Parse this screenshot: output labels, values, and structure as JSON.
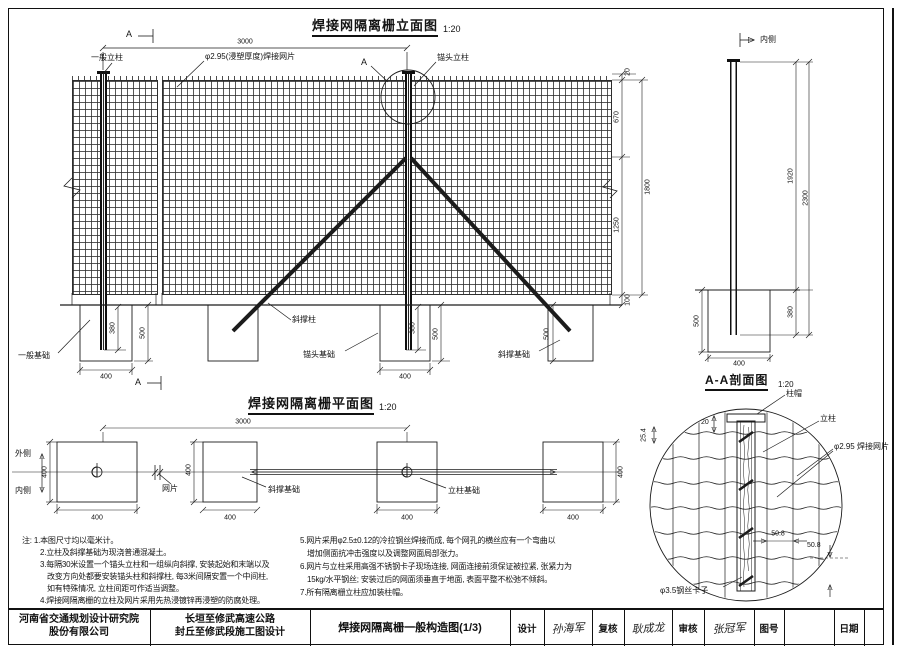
{
  "elevation": {
    "title": "焊接网隔离栅立面图",
    "scale": "1:20",
    "labels": {
      "post": "一般立柱",
      "mesh": "φ2.95(浸塑厚度)焊接网片",
      "anchor_post": "锚头立柱",
      "brace": "斜撑柱",
      "foundation_general": "一般基础",
      "foundation_anchor": "锚头基础",
      "foundation_brace": "斜撑基础",
      "marker": "A"
    },
    "dims": {
      "span": "3000",
      "top": "20",
      "upper": "670",
      "lower": "1250",
      "height": "1800",
      "gap": "100",
      "embed": "380",
      "depth": "500",
      "width": "400"
    }
  },
  "post_view": {
    "label": "内侧",
    "dims": {
      "above": "1920",
      "total": "2300",
      "embed": "380",
      "width": "400",
      "depth": "500"
    }
  },
  "plan": {
    "title": "焊接网隔离栅平面图",
    "scale": "1:20",
    "labels": {
      "outer": "外侧",
      "inner": "内侧",
      "mesh": "网片",
      "brace_foundation": "斜撑基础",
      "post_foundation": "立柱基础"
    },
    "dims": {
      "span": "3000",
      "size": "400"
    }
  },
  "section": {
    "title": "A-A剖面图",
    "scale": "1:20",
    "labels": {
      "cap": "柱帽",
      "post": "立柱",
      "mesh": "φ2.95 焊接网片",
      "clip": "φ3.5钢丝卡子"
    },
    "dims": {
      "cap_gap": "20",
      "edge": "25.4",
      "h_spacing": "50.8",
      "v_spacing": "50.8"
    }
  },
  "notes": {
    "left": [
      "注: 1.本图尺寸均以毫米计。",
      "2.立柱及斜撑基础为现浇普通混凝土。",
      "3.每隔30米设置一个锚头立柱和一组纵向斜撑, 安装起始和末端以及",
      "改变方向处都要安装锚头柱和斜撑柱, 每3米间隔安置一个中间柱,",
      "如有特殊情况, 立柱间距可作适当调整。",
      "4.焊接网隔离栅的立柱及网片采用先热浸镀锌再浸塑的防腐处理。"
    ],
    "right": [
      "5.网片采用φ2.5±0.12的冷拉钢丝焊接而成, 每个网孔的横丝应有一个弯曲以",
      "增加侧面抗冲击强度以及调整网面局部张力。",
      "6.网片与立柱采用高强不锈钢卡子现场连接, 网面连接前须保证被拉紧, 张紧力为",
      "15kg/水平钢丝; 安装过后的网面须垂直于地面, 表面平整不松弛不倾斜。",
      "7.所有隔离栅立柱应加装柱帽。"
    ]
  },
  "titleblock": {
    "company": [
      "河南省交通规划设计研究院",
      "股份有限公司"
    ],
    "project": [
      "长垣至修武高速公路",
      "封丘至修武段施工图设计"
    ],
    "drawing_title": "焊接网隔离栅一般构造图(1/3)",
    "fields": [
      {
        "label": "设计",
        "value": "孙海军"
      },
      {
        "label": "复核",
        "value": "耿成龙"
      },
      {
        "label": "审核",
        "value": "张冠军"
      },
      {
        "label": "图号",
        "value": ""
      },
      {
        "label": "日期",
        "value": ""
      }
    ]
  }
}
